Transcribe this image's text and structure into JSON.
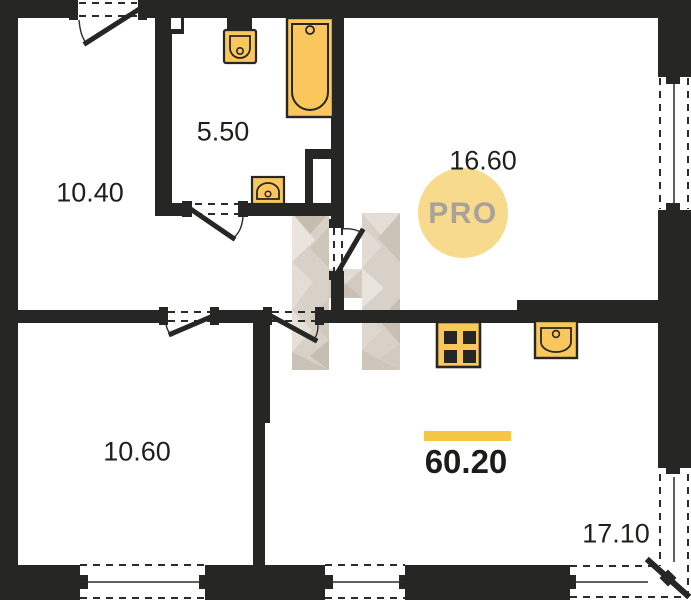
{
  "plan": {
    "rooms": [
      {
        "name": "top-left-room",
        "area": "10.40"
      },
      {
        "name": "bathroom",
        "area": "5.50"
      },
      {
        "name": "living-room",
        "area": "16.60"
      },
      {
        "name": "bottom-left-room",
        "area": "10.60"
      },
      {
        "name": "kitchen-living",
        "area": "17.10"
      }
    ],
    "total_area": "60.20",
    "watermark_badge": "PRO",
    "colors": {
      "wall": "#262624",
      "fixture_fill": "#F9C75C",
      "accent_bar": "#F6C544",
      "badge_bg": "#F8DA8C",
      "badge_text": "#A9A29A",
      "watermark_light": "#E6E0D9",
      "watermark_mid": "#D2C9BF",
      "watermark_dark": "#BCB2A5"
    }
  }
}
